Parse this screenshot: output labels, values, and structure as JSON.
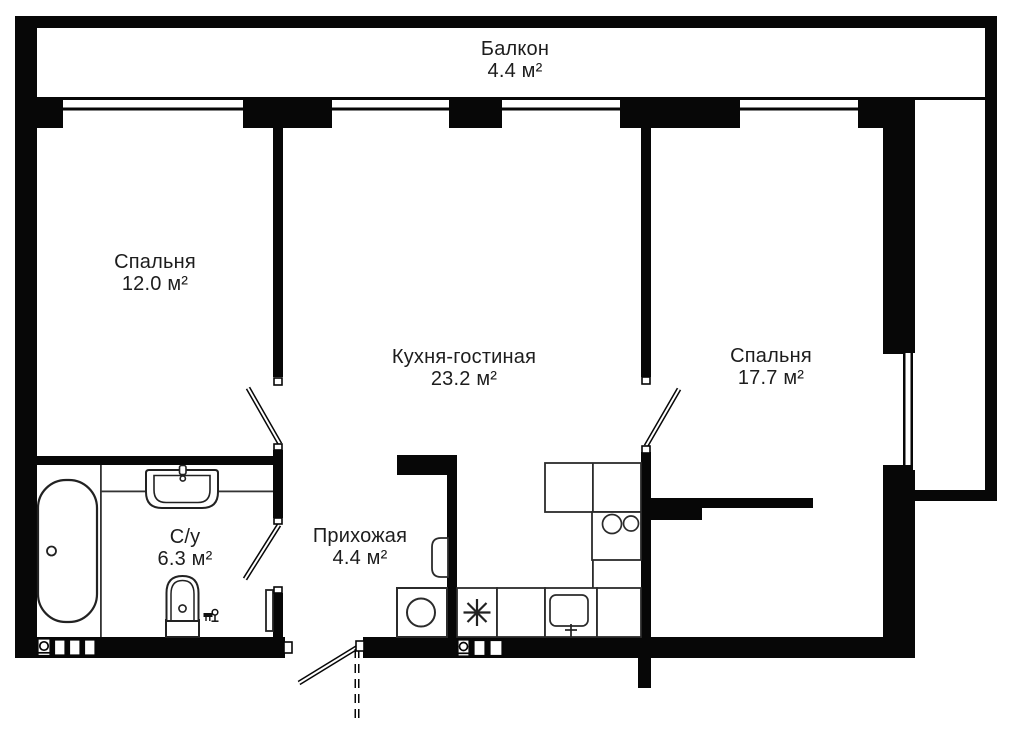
{
  "plan": {
    "type": "apartment-floor-plan",
    "rooms": [
      {
        "id": "balcony",
        "name": "Балкон",
        "area": "4.4 м²"
      },
      {
        "id": "bedroom-1",
        "name": "Спальня",
        "area": "12.0 м²"
      },
      {
        "id": "kitchen-living",
        "name": "Кухня-гостиная",
        "area": "23.2 м²"
      },
      {
        "id": "bedroom-2",
        "name": "Спальня",
        "area": "17.7 м²"
      },
      {
        "id": "bathroom",
        "name": "С/у",
        "area": "6.3 м²"
      },
      {
        "id": "hallway",
        "name": "Прихожая",
        "area": "4.4 м²"
      }
    ],
    "fixture_icons": [
      "bathtub-icon",
      "washbasin-icon",
      "toilet-icon",
      "towel-rail-icon",
      "washing-machine-icon",
      "stove-burner-icon",
      "kitchen-sink-icon",
      "double-hob-icon",
      "water-heater-icon",
      "ventilation-shaft-icon",
      "door-swing-icon",
      "window-icon"
    ],
    "colors": {
      "wall": "#070707",
      "background": "#ffffff",
      "line": "#2b2b2b",
      "text": "#1d1d1d"
    }
  }
}
